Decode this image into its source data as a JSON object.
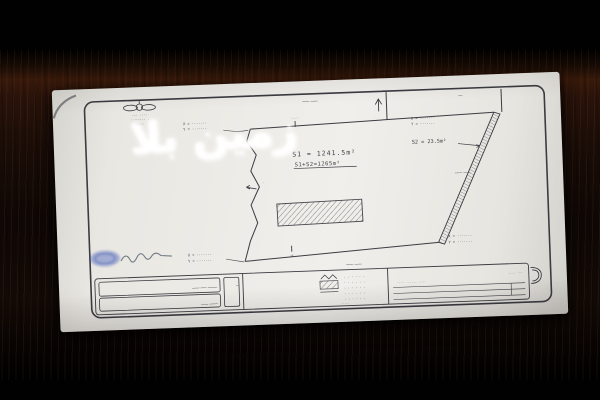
{
  "colors": {
    "paper": "#ebe9e4",
    "ink": "#3e3e44",
    "stamp_blue": "#3b55b8",
    "wood": "#2a150a",
    "background": "#020101"
  },
  "watermark": {
    "text": "زمین بلا"
  },
  "logo": {
    "line1": "··· ····",
    "line2": "· ······ ·",
    "line3": "·····"
  },
  "plot": {
    "s1_area": "S1 = 1241.5m²",
    "total_area": "S1+S2=1265m²",
    "s2_area": "S2 = 23.5m²",
    "coord_x": "X = ·······",
    "coord_y": "Y = ·······",
    "dim_tick": "··.··",
    "small_mark": "·4·",
    "edge_mark": "·",
    "neighbor_north": "ــــــ ــــــ",
    "neighbor_east": "ــــــ ــــــ",
    "neighbor_south": "ــــــ ــــــ",
    "street": "ــــ"
  },
  "titleblock": {
    "row1": "ــــــــ ـــــ ــــــ",
    "row2": "ـــــــ ــــــ",
    "left_dash": "ـــ",
    "dots": "· · · · · ·",
    "right_label": "···· ······ ····",
    "right_top": "···· ···",
    "scale_note": "·····"
  }
}
